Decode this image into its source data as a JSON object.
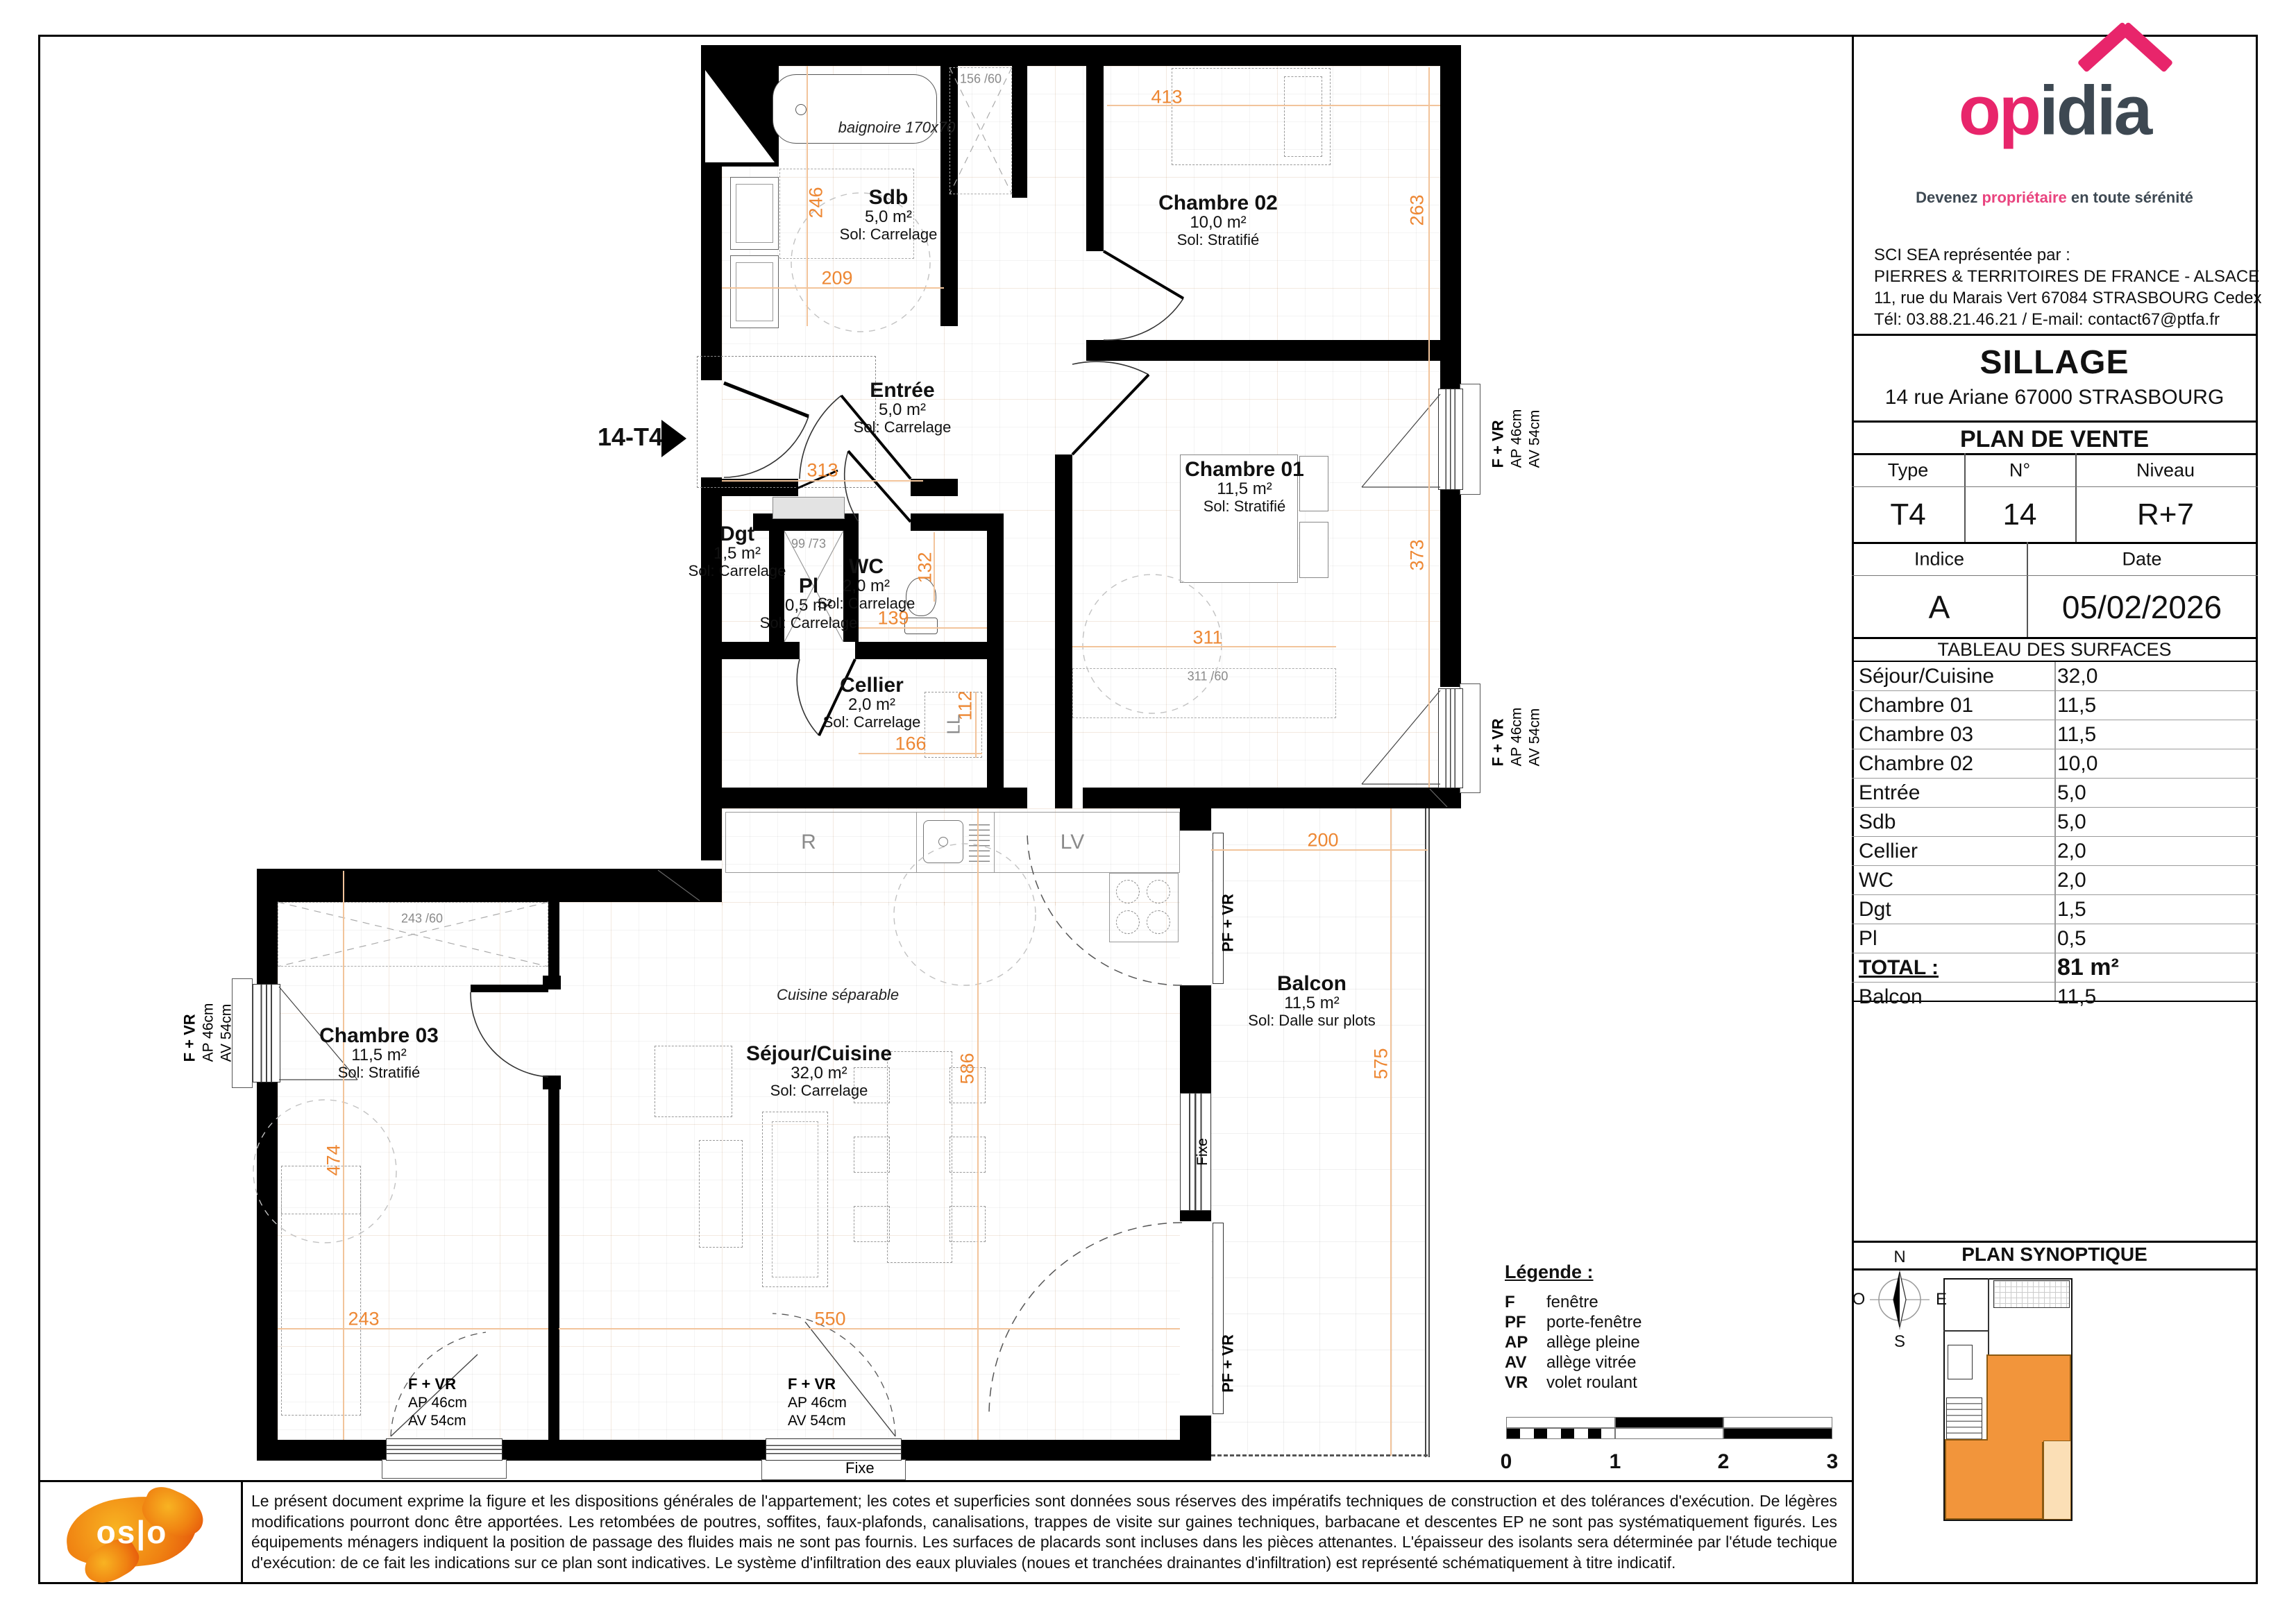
{
  "plan": {
    "unit_marker": "14-T4",
    "rooms": [
      {
        "id": "sdb",
        "name": "Sdb",
        "area": "5,0 m²",
        "floor": "Sol: Carrelage"
      },
      {
        "id": "chambre02",
        "name": "Chambre 02",
        "area": "10,0 m²",
        "floor": "Sol: Stratifié"
      },
      {
        "id": "entree",
        "name": "Entrée",
        "area": "5,0 m²",
        "floor": "Sol: Carrelage"
      },
      {
        "id": "dgt",
        "name": "Dgt",
        "area": "1,5 m²",
        "floor": "Sol: Carrelage"
      },
      {
        "id": "pl",
        "name": "Pl",
        "area": "0,5 m²",
        "floor": "Sol: Carrelage"
      },
      {
        "id": "wc",
        "name": "WC",
        "area": "2,0 m²",
        "floor": "Sol: Carrelage"
      },
      {
        "id": "cellier",
        "name": "Cellier",
        "area": "2,0 m²",
        "floor": "Sol: Carrelage"
      },
      {
        "id": "chambre01",
        "name": "Chambre 01",
        "area": "11,5 m²",
        "floor": "Sol: Stratifié"
      },
      {
        "id": "chambre03",
        "name": "Chambre 03",
        "area": "11,5 m²",
        "floor": "Sol: Stratifié"
      },
      {
        "id": "sejour",
        "name": "Séjour/Cuisine",
        "area": "32,0 m²",
        "floor": "Sol: Carrelage"
      },
      {
        "id": "balcon",
        "name": "Balcon",
        "area": "11,5 m²",
        "floor": "Sol: Dalle sur plots"
      }
    ],
    "dims": [
      {
        "v": "413"
      },
      {
        "v": "246"
      },
      {
        "v": "209"
      },
      {
        "v": "263"
      },
      {
        "v": "313"
      },
      {
        "v": "132"
      },
      {
        "v": "139"
      },
      {
        "v": "112"
      },
      {
        "v": "166"
      },
      {
        "v": "373"
      },
      {
        "v": "311"
      },
      {
        "v": "200"
      },
      {
        "v": "586"
      },
      {
        "v": "575"
      },
      {
        "v": "474"
      },
      {
        "v": "243"
      },
      {
        "v": "550"
      }
    ],
    "notes": {
      "baignoire": "baignoire 170x70",
      "cuisine": "Cuisine séparable",
      "closet_entree": "156 /60",
      "pl_dim": "99 /73",
      "closet_ch03": "243 /60",
      "closet_ch01": "311 /60",
      "ll": "LL",
      "r": "R",
      "lv": "LV"
    },
    "window_labels": {
      "f_vr": "F + VR",
      "ap": "AP 46cm",
      "av": "AV 54cm",
      "pf_vr": "PF + VR",
      "fixe": "Fixe"
    },
    "legend": {
      "title": "Légende :",
      "items": [
        {
          "k": "F",
          "v": "fenêtre"
        },
        {
          "k": "PF",
          "v": "porte-fenêtre"
        },
        {
          "k": "AP",
          "v": "allège pleine"
        },
        {
          "k": "AV",
          "v": "allège vitrée"
        },
        {
          "k": "VR",
          "v": "volet roulant"
        }
      ]
    },
    "scale": [
      "0",
      "1",
      "2",
      "3"
    ]
  },
  "panel": {
    "logo": {
      "brand_1": "op",
      "brand_2": "idia",
      "tagline_1": "Devenez ",
      "tagline_pink": "propriétaire",
      "tagline_2": " en toute sérénité"
    },
    "company": [
      "SCI SEA représentée par :",
      "PIERRES & TERRITOIRES DE FRANCE - ALSACE",
      "11, rue du Marais Vert 67084 STRASBOURG Cedex",
      "Tél: 03.88.21.46.21 / E-mail: contact67@ptfa.fr"
    ],
    "project": {
      "name": "SILLAGE",
      "address": "14 rue Ariane 67000 STRASBOURG"
    },
    "doc_title": "PLAN DE VENTE",
    "info": {
      "type_label": "Type",
      "type": "T4",
      "num_label": "N°",
      "num": "14",
      "niveau_label": "Niveau",
      "niveau": "R+7",
      "indice_label": "Indice",
      "indice": "A",
      "date_label": "Date",
      "date": "05/02/2026"
    },
    "surfaces": {
      "title": "TABLEAU DES SURFACES",
      "rows": [
        {
          "name": "Séjour/Cuisine",
          "value": "32,0"
        },
        {
          "name": "Chambre 01",
          "value": "11,5"
        },
        {
          "name": "Chambre 03",
          "value": "11,5"
        },
        {
          "name": "Chambre 02",
          "value": "10,0"
        },
        {
          "name": "Entrée",
          "value": "5,0"
        },
        {
          "name": "Sdb",
          "value": "5,0"
        },
        {
          "name": "Cellier",
          "value": "2,0"
        },
        {
          "name": "WC",
          "value": "2,0"
        },
        {
          "name": "Dgt",
          "value": "1,5"
        },
        {
          "name": "Pl",
          "value": "0,5"
        }
      ],
      "total_label": "TOTAL :",
      "total": "81 m²",
      "balcon_label": "Balcon",
      "balcon": "11,5"
    },
    "synoptique": {
      "title": "PLAN SYNOPTIQUE",
      "compass": {
        "n": "N",
        "e": "E",
        "s": "S",
        "o": "O"
      }
    }
  },
  "footer": {
    "logo_text": "os|o",
    "disclaimer": "Le présent document exprime la figure et les dispositions générales de l'appartement; les cotes et superficies sont données sous réserves des impératifs techniques de construction et des tolérances d'exécution. De légères modifications pourront donc être apportées. Les retombées de poutres, soffites, faux-plafonds, canalisations, trappes de visite sur gaines techniques, barbacane et descentes EP ne sont pas systématiquement figurés. Les équipements ménagers indiquent la position de passage des fluides mais ne sont pas fournis. Les surfaces de placards sont incluses dans les pièces attenantes. L'épaisseur des isolants sera déterminée par l'étude techique d'exécution: de ce fait les indications sur ce plan sont indicatives. Le système d'infiltration des eaux pluviales (noues et tranchées drainantes d'infiltration) est représenté schématiquement à titre indicatif."
  }
}
